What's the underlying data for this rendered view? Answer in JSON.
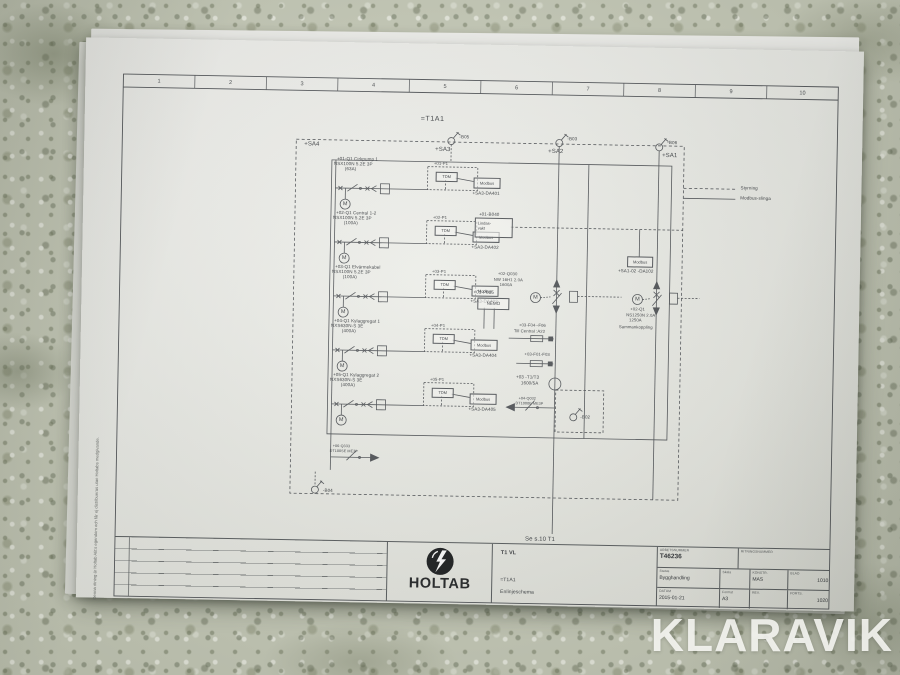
{
  "watermark": "KLARAVIK",
  "ruler": [
    "1",
    "2",
    "3",
    "4",
    "5",
    "6",
    "7",
    "8",
    "9",
    "10"
  ],
  "side_note": "Denna ritning är Holtab AB:s egendom och får ej distribueras utan Holtabs medgivande.",
  "diagram": {
    "title": "=T1A1",
    "motor_symbol": "M",
    "zones": {
      "sa4": "+SA4",
      "sa3": "+SA3",
      "sa2": "+SA2",
      "sa1": "+SA1"
    },
    "markers": {
      "b05": "-B05",
      "b03": "-B03",
      "b06": "-B06",
      "b04": "-B04",
      "b02": "-B02"
    },
    "legend": {
      "styrning": "Styrning",
      "modbus": "Modbus-slinga"
    },
    "feeders": [
      {
        "id": "+01-Q1  Cirkpump 1",
        "type": "NSX100N 5.2E 3P",
        "amp": "(63A)",
        "p": "+01-P1",
        "tdm": "TDM",
        "modbus": "Modbus",
        "out": "+SA3-DA401"
      },
      {
        "id": "+02-Q1  Central 1-2",
        "type": "NSX100N 5.2E 3P",
        "amp": "(100A)",
        "p": "+02-P1",
        "tdm": "TDM",
        "modbus": "Modbus",
        "out": "+SA3-DA402"
      },
      {
        "id": "+03-Q1  Elvärmekabel",
        "type": "NSX100N 5.2E 3P",
        "amp": "(100A)",
        "p": "+03-P1",
        "tdm": "TDM",
        "modbus": "Modbus",
        "out": "+SA3-DA403"
      },
      {
        "id": "+04-Q1  Kylaggregat 1",
        "type": "NXS630N-S 3E",
        "amp": "(400A)",
        "p": "+04-P1",
        "tdm": "TDM",
        "modbus": "Modbus",
        "out": "+SA3-DA404"
      },
      {
        "id": "+05-Q1  Kylaggregat 2",
        "type": "NXS630N-S 3E",
        "amp": "(400A)",
        "p": "+05-P1",
        "tdm": "TDM",
        "modbus": "Modbus",
        "out": "+SA3-DA405"
      }
    ],
    "q333": {
      "id": "+06-Q333",
      "type": "DT100SE ME3P"
    },
    "b040": {
      "id": "+01-B040",
      "box_line1": "Lindas-",
      "box_line2": "vakt"
    },
    "q030": {
      "id": "+02-Q030",
      "type": "NW 16H1 2.0A",
      "amp": "1600A"
    },
    "p035": {
      "id": "+01-P035",
      "box": "NEMO"
    },
    "f0406": {
      "id": "+03-F04--F06",
      "note": "Till Central :A22"
    },
    "f0103": {
      "id": "+03-F01-F03"
    },
    "t1t3": {
      "id": "+03 -T1/T3",
      "ratio": "1600/5A"
    },
    "q032": {
      "id": "+04-Q032",
      "type": "DT1000E ME3P"
    },
    "da102": {
      "modbus": "Modbus",
      "id": "+SA1-02 -DA102"
    },
    "q1": {
      "id": "+02-Q1",
      "type": "NS1250N 2.0A",
      "amp": "1250A",
      "note": "Sammankoppling"
    },
    "see_note": "Se s.10 T1"
  },
  "titleblock": {
    "logo_text": "HOLTAB",
    "project": "T1 VL",
    "system": "=T1A1",
    "doc_type": "Enlinjeschema",
    "arbetsnummer_label": "ARBETSNUMMER",
    "arbetsnummer": "T46236",
    "ritningsnummer_label": "RITNINGSNUMMER",
    "status_label": "Status",
    "status": "Bygghandling",
    "skala_label": "Skala",
    "konstr_label": "KONSTR.",
    "konstr": "MAS",
    "blad_label": "BLAD",
    "blad": "1010",
    "datum_label": "DATUM",
    "datum": "2015-01-21",
    "format_label": "Format",
    "format": "A3",
    "rev_label": "REV.",
    "forts_label": "FORTS.",
    "forts": "1020"
  }
}
